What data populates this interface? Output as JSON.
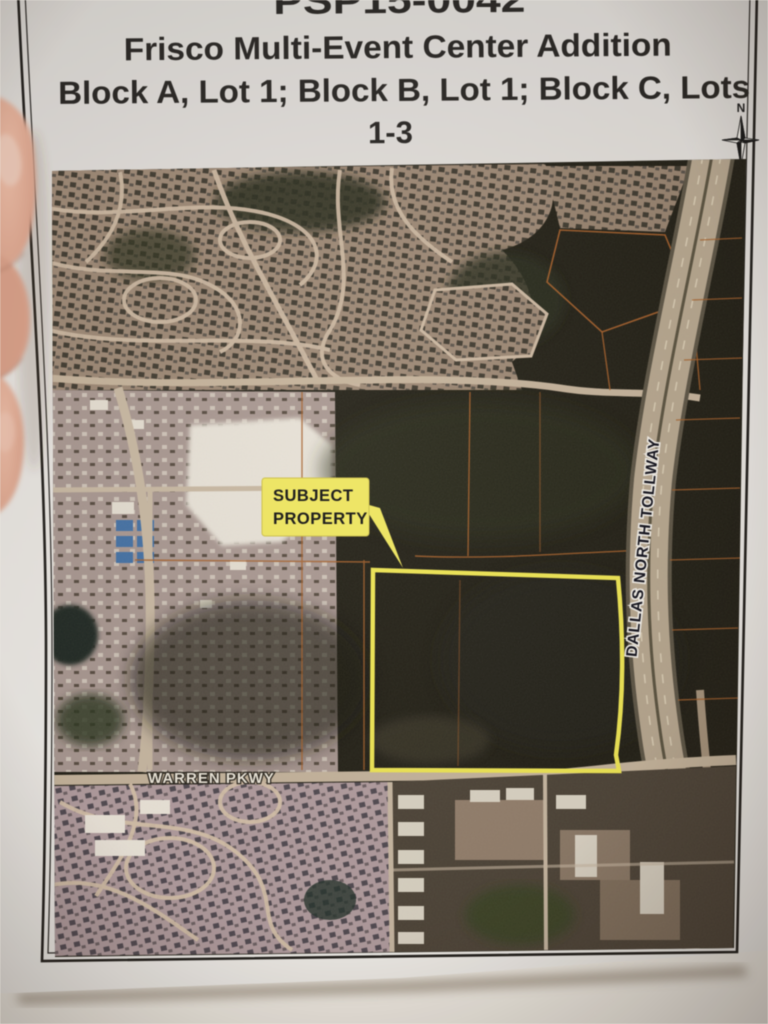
{
  "document": {
    "case_number": "PSP15-0042",
    "title": "Frisco Multi-Event Center Addition",
    "subtitle_line1": "Block A, Lot 1; Block B, Lot 1; Block C, Lots",
    "subtitle_line2": "1-3"
  },
  "map": {
    "callout": {
      "line1": "SUBJECT",
      "line2": "PROPERTY"
    },
    "road_labels": {
      "warren": "WARREN PKWY",
      "tollway": "DALLAS NORTH TOLLWAY"
    },
    "compass": {
      "north": "N"
    },
    "colors": {
      "property_outline": "#f2e84e",
      "callout_bg": "#f0e75e",
      "parcel_line": "#a85f28",
      "road": "#c6b49b",
      "field_dark": "#1e1c14"
    }
  }
}
